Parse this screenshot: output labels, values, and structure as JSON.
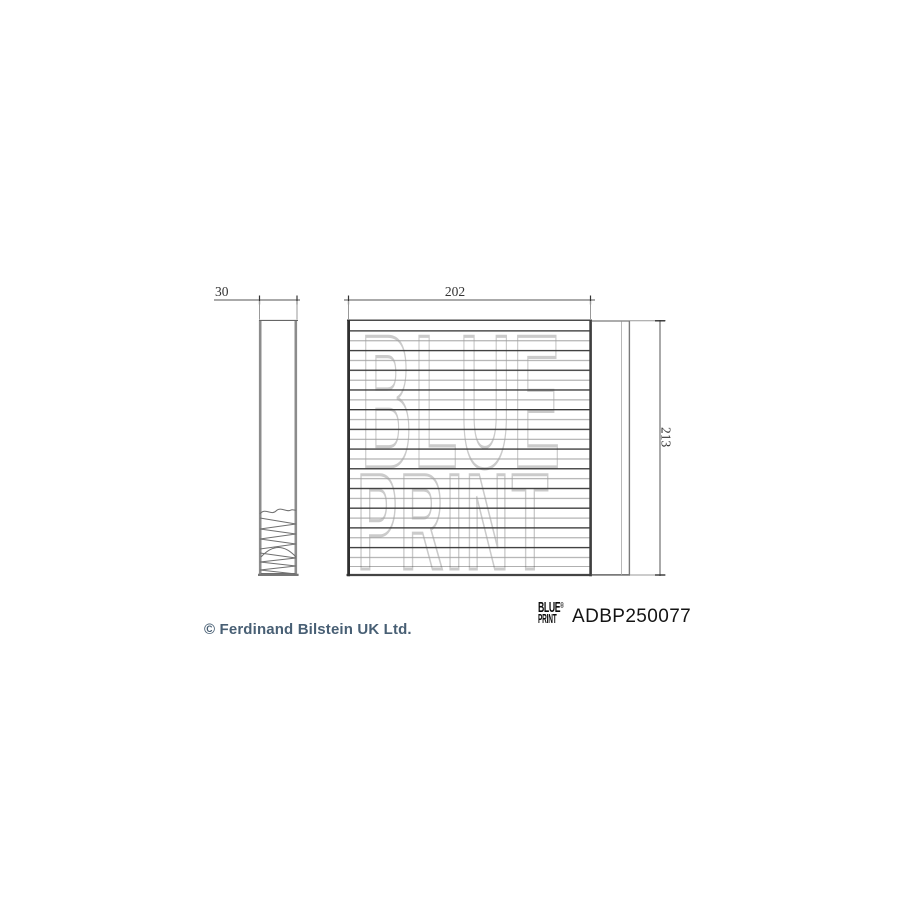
{
  "page": {
    "background_color": "#ffffff"
  },
  "watermark": {
    "line1": "BLUE",
    "line2": "PRINT",
    "color": "#cbcbcb"
  },
  "drawing": {
    "type": "technical-part-drawing",
    "part_kind": "cabin-filter",
    "dim_side_width": "30",
    "dim_front_width": "202",
    "dim_front_height": "213",
    "line_color": "#444444",
    "outline_color": "#8a8a8a"
  },
  "footer": {
    "logo_top": "BLUE",
    "logo_reg": "®",
    "logo_bottom": "PRINT",
    "part_number": "ADBP250077",
    "copyright": "© Ferdinand Bilstein UK Ltd.",
    "copyright_color": "#485f74",
    "part_number_color": "#141414"
  }
}
